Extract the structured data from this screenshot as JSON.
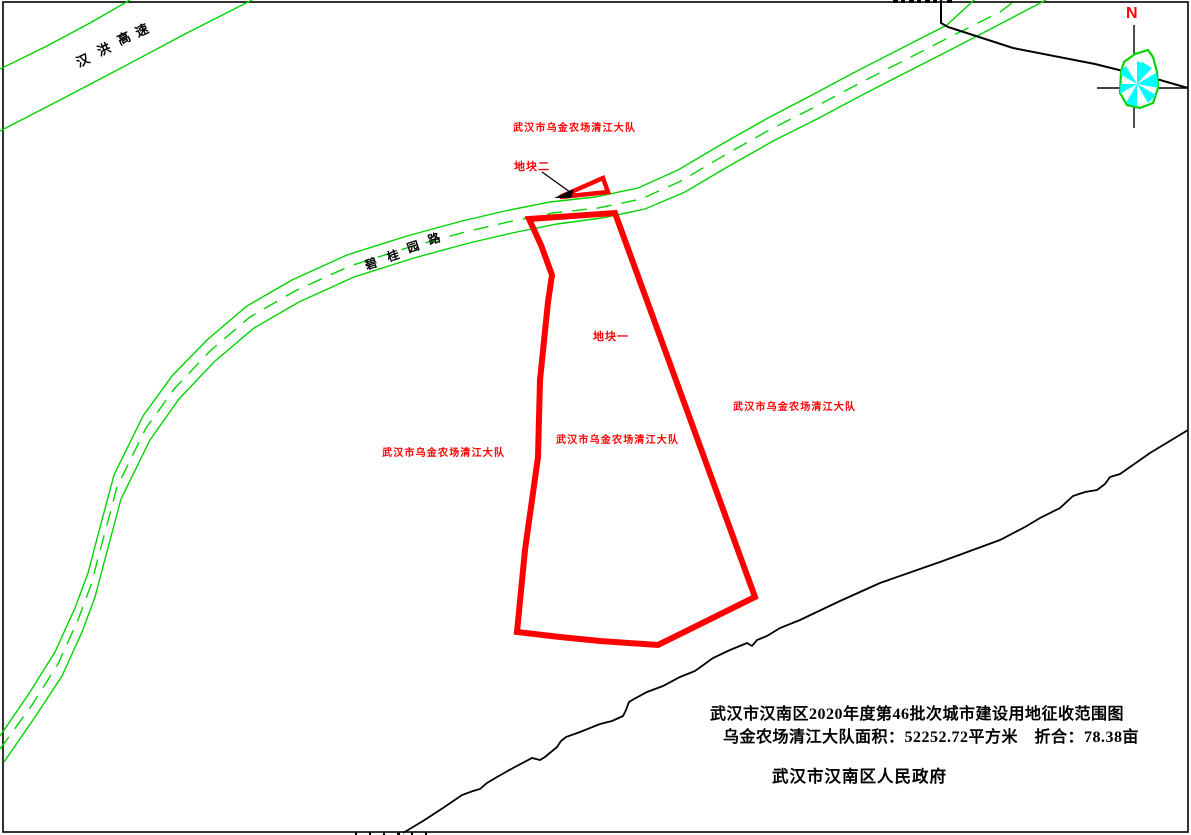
{
  "map_title": "武汉市汉南区2020年度第46批次城市建设用地征收范围图",
  "roads": {
    "hanhong": {
      "name": "汉洪高速",
      "chars": [
        "汉",
        "洪",
        "高",
        "速"
      ]
    },
    "biguiyuan": {
      "name": "碧桂园路",
      "chars": [
        "碧",
        "桂",
        "园",
        "路"
      ]
    }
  },
  "area_labels": {
    "owner": "武汉市乌金农场清江大队"
  },
  "parcels": {
    "parcel1": {
      "label": "地块一"
    },
    "parcel2": {
      "label": "地块二"
    }
  },
  "compass": {
    "north": "N"
  },
  "title_block": {
    "line1": "武汉市汉南区2020年度第46批次城市建设用地征收范围图",
    "line2": "乌金农场清江大队面积：52252.72平方米　折合：78.38亩",
    "line3": "武汉市汉南区人民政府"
  },
  "colors": {
    "road_green": "#00d400",
    "parcel_red": "#ff0000",
    "label_red": "#ff0000",
    "compass_cyan": "#00ffff",
    "boundary_black": "#000000",
    "north_red": "#ff0000"
  }
}
